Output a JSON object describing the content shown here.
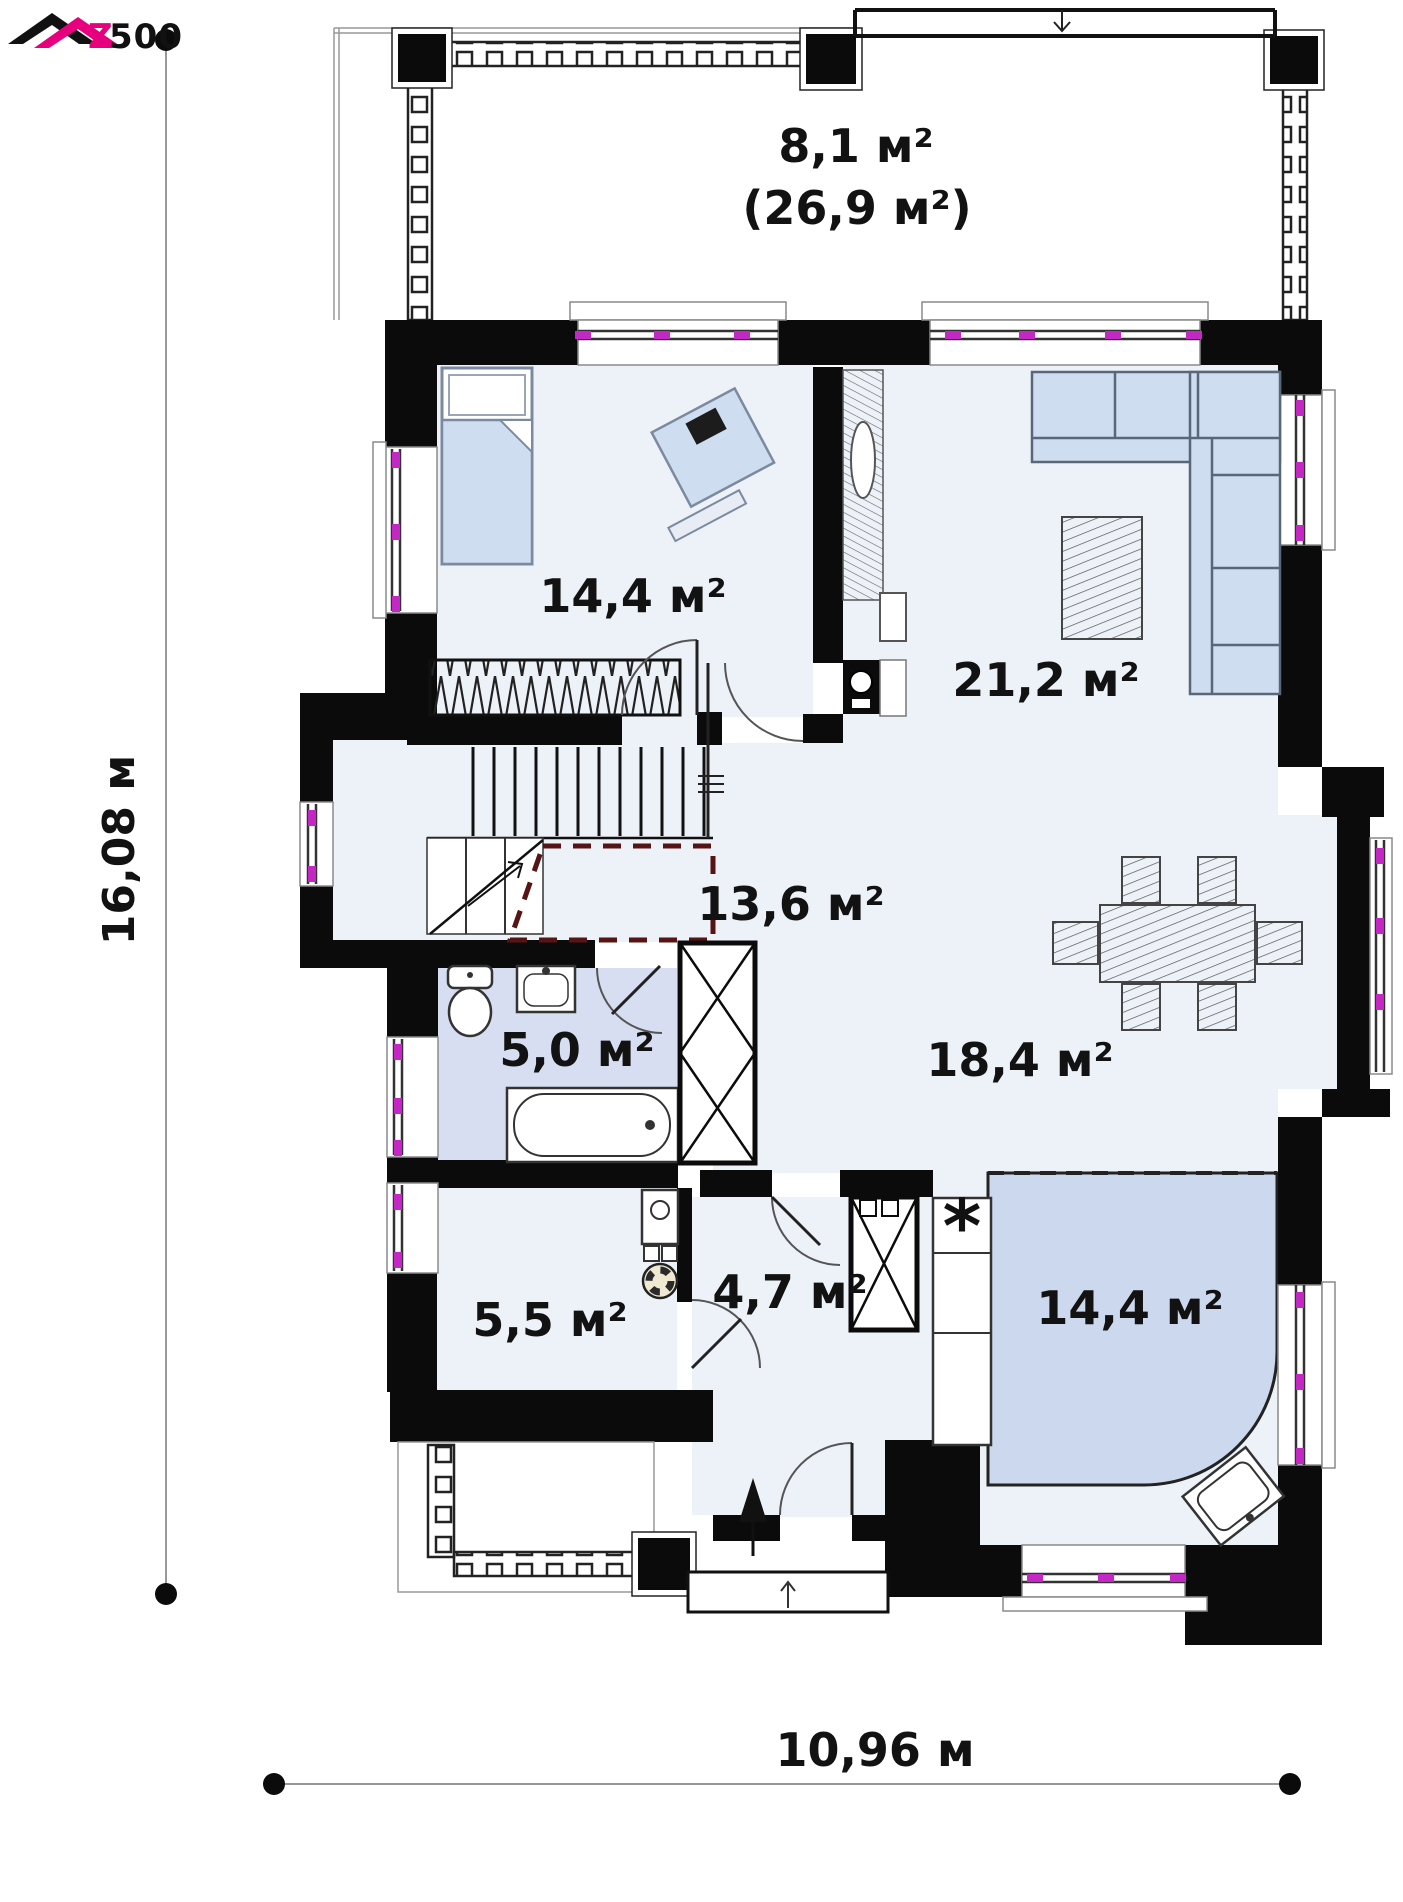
{
  "logo": {
    "z": "Z",
    "rest": "500"
  },
  "dimensions": {
    "height_label": "16,08 м",
    "width_label": "10,96 м"
  },
  "rooms": {
    "terrace": {
      "area": "8,1 м²",
      "total": "(26,9 м²)"
    },
    "bedroom": {
      "area": "14,4 м²"
    },
    "living": {
      "area": "21,2 м²"
    },
    "hall": {
      "area": "13,6 м²"
    },
    "bath": {
      "area": "5,0 м²"
    },
    "dining": {
      "area": "18,4 м²"
    },
    "utility": {
      "area": "5,5 м²"
    },
    "corridor": {
      "area": "4,7 м²"
    },
    "kitchen": {
      "area": "14,4 м²"
    }
  },
  "symbols": {
    "fridge": "*"
  },
  "colors": {
    "brand_pink": "#e6007e",
    "wall": "#0b0b0b",
    "floor": "#edf1f8",
    "furniture": "#cfddf0",
    "bath_floor": "#d7def1",
    "kitchen_zone": "#cbd8ee",
    "window_tick": "#c428c4",
    "void_dash": "#571414"
  }
}
